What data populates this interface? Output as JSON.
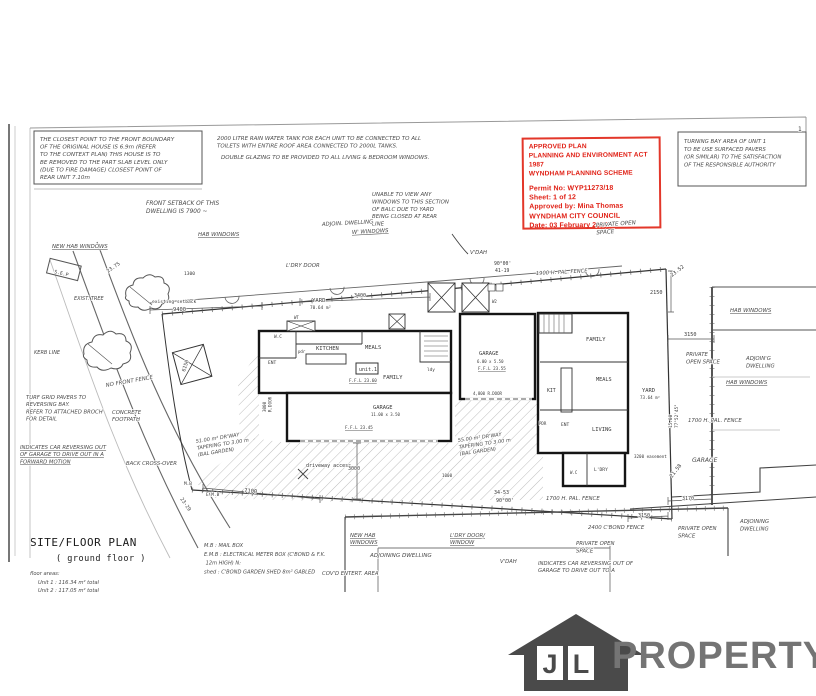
{
  "stamp": {
    "border_color": "#e3372a",
    "text_color": "#e01f14",
    "lines": [
      "APPROVED PLAN",
      "PLANNING AND ENVIRONMENT ACT 1987",
      "WYNDHAM PLANNING SCHEME",
      "Permit No:  WYP11273/18",
      "Sheet:  1 of 12",
      "Approved by:  Mina Thomas",
      "WYNDHAM CITY COUNCIL",
      "Date:  03 February 2020"
    ]
  },
  "logo": {
    "letters": [
      "J",
      "L"
    ],
    "name": "PROPERTY"
  },
  "plan": {
    "labels": [
      {
        "n": "note-boundary",
        "c": "hw",
        "x": 40,
        "y": 141,
        "s": 5.6,
        "lh": 7.6,
        "t": [
          "THE CLOSEST POINT TO THE FRONT BOUNDARY",
          "OF THE ORIGINAL HOUSE IS 6.9m (REFER",
          "TO THE CONTEXT PLAN) THIS HOUSE IS TO",
          "BE REMOVED TO THE PART SLAB LEVEL ONLY",
          "(DUE TO FIRE DAMAGE) CLOSEST POINT OF",
          "REAR UNIT  7.10m"
        ]
      },
      {
        "n": "note-rainwater",
        "c": "hw",
        "x": 217,
        "y": 140,
        "s": 5.5,
        "lh": 7.4,
        "t": [
          "2000 LITRE RAIN WATER TANK FOR EACH UNIT TO BE CONNECTED TO ALL",
          "TOILETS WITH ENTIRE ROOF AREA CONNECTED TO 2000L TANKS."
        ]
      },
      {
        "n": "note-glazing",
        "c": "hw",
        "x": 221,
        "y": 159,
        "s": 5.5,
        "t": "DOUBLE GLAZING TO BE PROVIDED TO ALL LIVING & BEDROOM WINDOWS."
      },
      {
        "n": "note-turning-bay",
        "c": "hw",
        "x": 684,
        "y": 143,
        "s": 5.4,
        "lh": 7.8,
        "t": [
          "TURNING BAY AREA OF UNIT 1",
          "TO BE USE SURFACED PAVERS",
          "(OR SIMILAR) TO THE SATISFACTION",
          "OF THE RESPONSIBLE AUTHORITY"
        ]
      },
      {
        "n": "note-front-setback",
        "c": "hw",
        "x": 146,
        "y": 205,
        "s": 5.8,
        "lh": 8.2,
        "t": [
          "FRONT SETBACK OF THIS",
          "DWELLING IS 7900 ~"
        ]
      },
      {
        "n": "note-balcony",
        "c": "hw",
        "x": 372,
        "y": 196,
        "s": 5.4,
        "lh": 7.4,
        "t": [
          "UNABLE TO VIEW ANY",
          "WINDOWS TO THIS SECTION",
          "OF BALC DUE TO YARD",
          "BEING CLOSED AT REAR",
          "LINE"
        ]
      },
      {
        "n": "stamp-handwriting",
        "c": "hw",
        "x": 596,
        "y": 227,
        "s": 5.6,
        "lh": 7.4,
        "r": -4,
        "t": [
          "PRIVATE OPEN",
          "SPACE"
        ]
      },
      {
        "c": "hw",
        "x": 322,
        "y": 226,
        "s": 5.4,
        "r": -3,
        "t": "ADJOIN. DWELLING"
      },
      {
        "c": "hw",
        "x": 352,
        "y": 234,
        "s": 5.4,
        "r": -3,
        "u": 1,
        "t": "W' WINDOWS"
      },
      {
        "c": "hw",
        "x": 198,
        "y": 236,
        "s": 5.4,
        "u": 1,
        "t": "HAB WINDOWS"
      },
      {
        "c": "hw",
        "x": 52,
        "y": 248,
        "s": 5.4,
        "u": 1,
        "t": "NEW HAB WINDOWS"
      },
      {
        "c": "hw",
        "x": 286,
        "y": 267,
        "s": 5.4,
        "t": "L'DRY DOOR"
      },
      {
        "c": "hw",
        "x": 470,
        "y": 254,
        "s": 5.4,
        "t": "V'DAH"
      },
      {
        "c": "hw",
        "x": 536,
        "y": 275,
        "s": 5.2,
        "r": -3,
        "t": "1900 H. PAL. FENCE"
      },
      {
        "c": "pr",
        "x": 494,
        "y": 265,
        "s": 4.8,
        "t": "90°00'"
      },
      {
        "c": "pr",
        "x": 495,
        "y": 272,
        "s": 4.8,
        "t": "41-19"
      },
      {
        "c": "pr",
        "x": 650,
        "y": 294,
        "s": 5.2,
        "t": "2150"
      },
      {
        "c": "pr",
        "x": 672,
        "y": 277,
        "s": 5.2,
        "r": -38,
        "t": "23.52"
      },
      {
        "c": "pr",
        "x": 684,
        "y": 336,
        "s": 5.2,
        "t": "3150"
      },
      {
        "c": "hw",
        "x": 730,
        "y": 312,
        "s": 5.4,
        "u": 1,
        "t": "HAB WINDOWS"
      },
      {
        "c": "hw",
        "x": 686,
        "y": 356,
        "s": 5.4,
        "lh": 7.4,
        "t": [
          "PRIVATE",
          "OPEN SPACE"
        ]
      },
      {
        "c": "hw",
        "x": 746,
        "y": 360,
        "s": 5.4,
        "lh": 7.4,
        "t": [
          "ADJOIN'G",
          "DWELLING"
        ]
      },
      {
        "c": "hw",
        "x": 726,
        "y": 384,
        "s": 5.4,
        "u": 1,
        "t": "HAB WINDOWS"
      },
      {
        "c": "pr",
        "x": 152,
        "y": 303,
        "s": 4.6,
        "t": "existing setback"
      },
      {
        "c": "pr",
        "x": 173,
        "y": 311,
        "s": 5.4,
        "t": "9400"
      },
      {
        "c": "pr",
        "x": 184,
        "y": 275,
        "s": 4.6,
        "t": "1300"
      },
      {
        "c": "pr",
        "x": 312,
        "y": 302,
        "s": 5.6,
        "t": "YARD"
      },
      {
        "c": "pr",
        "x": 310,
        "y": 309,
        "s": 4.4,
        "t": "70.64 m²"
      },
      {
        "c": "pr",
        "x": 354,
        "y": 297,
        "s": 5,
        "t": "3400"
      },
      {
        "c": "pr",
        "x": 108,
        "y": 273,
        "s": 5,
        "r": -35,
        "t": "23.75"
      },
      {
        "c": "pr",
        "x": 54,
        "y": 273,
        "s": 4.8,
        "r": 14,
        "t": "S.E.P"
      },
      {
        "c": "hw",
        "x": 74,
        "y": 300,
        "s": 5,
        "t": "EXIST. TREE"
      },
      {
        "c": "hw",
        "x": 34,
        "y": 354,
        "s": 5,
        "t": "KERB LINE"
      },
      {
        "c": "hw",
        "x": 106,
        "y": 387,
        "s": 5.4,
        "r": -10,
        "t": "NO FRONT FENCE"
      },
      {
        "n": "note-turf-pavers",
        "c": "hw",
        "x": 26,
        "y": 399,
        "s": 5.3,
        "lh": 7.2,
        "t": [
          "TURF GRID PAVERS TO",
          "REVERSING BAY.",
          "REFER TO ATTACHED BROCH",
          "FOR DETAIL"
        ]
      },
      {
        "c": "hw",
        "x": 112,
        "y": 414,
        "s": 5.3,
        "lh": 7.2,
        "t": [
          "CONCRETE",
          "FOOTPATH"
        ]
      },
      {
        "n": "note-reversing",
        "c": "hw",
        "x": 20,
        "y": 449,
        "s": 5.3,
        "lh": 7.2,
        "u": 1,
        "t": [
          "INDICATES CAR REVERSING OUT",
          "OF GARAGE TO DRIVE OUT IN A",
          "FORWARD MOTION"
        ]
      },
      {
        "c": "hw",
        "x": 126,
        "y": 465,
        "s": 5.3,
        "t": "BACK CROSS-OVER"
      },
      {
        "c": "pr",
        "x": 185,
        "y": 372,
        "s": 5,
        "r": -72,
        "t": "6150"
      },
      {
        "c": "hw",
        "x": 196,
        "y": 443,
        "s": 5,
        "lh": 6.8,
        "r": -9,
        "t": [
          "51.00 m² DR'WAY",
          "TAPERING TO 3.00 m",
          "(BAL GARDEN)"
        ]
      },
      {
        "c": "hw",
        "x": 458,
        "y": 442,
        "s": 5,
        "lh": 6.8,
        "r": -8,
        "t": [
          "55.00 m² DR'WAY",
          "TAPERING TO 3.00 m",
          "(BAL GARDEN)"
        ]
      },
      {
        "c": "pr",
        "x": 306,
        "y": 467,
        "s": 5,
        "t": "driveway access"
      },
      {
        "c": "pr",
        "x": 348,
        "y": 470,
        "s": 5,
        "t": "3000"
      },
      {
        "c": "pr",
        "x": 442,
        "y": 477,
        "s": 4.2,
        "t": "1000"
      },
      {
        "c": "pr",
        "x": 244,
        "y": 492,
        "s": 5.4,
        "r": 6,
        "t": "7100"
      },
      {
        "c": "pr",
        "x": 180,
        "y": 499,
        "s": 5,
        "r": 55,
        "t": "23-29"
      },
      {
        "c": "pr",
        "x": 184,
        "y": 485,
        "s": 4.4,
        "t": "M.B"
      },
      {
        "c": "pr",
        "x": 206,
        "y": 496,
        "s": 4.4,
        "t": "E.M.B"
      },
      {
        "c": "pr",
        "x": 274,
        "y": 338,
        "s": 4.4,
        "t": "W.C"
      },
      {
        "c": "pr",
        "x": 298,
        "y": 353,
        "s": 4,
        "t": "pdr"
      },
      {
        "c": "pr",
        "x": 268,
        "y": 364,
        "s": 4.6,
        "t": "ENT"
      },
      {
        "c": "pr",
        "x": 316,
        "y": 350,
        "s": 5.4,
        "t": "KITCHEN"
      },
      {
        "c": "pr",
        "x": 365,
        "y": 349,
        "s": 5.4,
        "t": "MEALS"
      },
      {
        "n": "unit1-label",
        "c": "pr",
        "x": 359,
        "y": 371,
        "s": 5,
        "t": "unit.1"
      },
      {
        "c": "pr",
        "x": 349,
        "y": 382,
        "s": 4.2,
        "u": 1,
        "t": "F.F.L  23.60"
      },
      {
        "c": "pr",
        "x": 383,
        "y": 379,
        "s": 5.4,
        "t": "FAMILY"
      },
      {
        "c": "pr",
        "x": 427,
        "y": 371,
        "s": 4.4,
        "t": "ldy"
      },
      {
        "c": "pr",
        "x": 294,
        "y": 319,
        "s": 4,
        "t": "WT"
      },
      {
        "c": "pr",
        "x": 373,
        "y": 409,
        "s": 5.4,
        "t": "GARAGE"
      },
      {
        "c": "pr",
        "x": 371,
        "y": 416,
        "s": 4,
        "t": "11.00 x 3.50"
      },
      {
        "c": "pr",
        "x": 345,
        "y": 429,
        "s": 4.2,
        "u": 1,
        "t": "F.F.L 23.45"
      },
      {
        "c": "pr",
        "x": 266,
        "y": 412,
        "s": 4.2,
        "r": -90,
        "lh": 5.6,
        "t": [
          "3000",
          "R.DOOR"
        ]
      },
      {
        "c": "pr",
        "x": 479,
        "y": 355,
        "s": 5.4,
        "t": "GARAGE"
      },
      {
        "c": "pr",
        "x": 477,
        "y": 363,
        "s": 4,
        "t": "6.00 x 5.50"
      },
      {
        "c": "pr",
        "x": 478,
        "y": 370,
        "s": 4.2,
        "u": 1,
        "t": "F.F.L 23.55"
      },
      {
        "c": "pr",
        "x": 473,
        "y": 395,
        "s": 4,
        "t": "4,800 R.DOOR"
      },
      {
        "c": "pr",
        "x": 492,
        "y": 303,
        "s": 4,
        "t": "W2"
      },
      {
        "c": "pr",
        "x": 586,
        "y": 341,
        "s": 5.4,
        "t": "FAMILY"
      },
      {
        "c": "pr",
        "x": 596,
        "y": 381,
        "s": 5.2,
        "t": "MEALS"
      },
      {
        "c": "pr",
        "x": 547,
        "y": 392,
        "s": 4.8,
        "t": "KIT"
      },
      {
        "c": "pr",
        "x": 539,
        "y": 425,
        "s": 4,
        "t": "PDR"
      },
      {
        "c": "pr",
        "x": 561,
        "y": 426,
        "s": 4.6,
        "t": "ENT"
      },
      {
        "c": "pr",
        "x": 592,
        "y": 431,
        "s": 5.4,
        "t": "LIVING"
      },
      {
        "c": "pr",
        "x": 594,
        "y": 471,
        "s": 4.6,
        "t": "L'DRY"
      },
      {
        "c": "pr",
        "x": 570,
        "y": 474,
        "s": 4,
        "t": "W.C"
      },
      {
        "c": "pr",
        "x": 642,
        "y": 392,
        "s": 5.4,
        "t": "YARD"
      },
      {
        "c": "pr",
        "x": 640,
        "y": 399,
        "s": 4.2,
        "t": "73.64 m²"
      },
      {
        "c": "pr",
        "x": 672,
        "y": 428,
        "s": 4.4,
        "r": -90,
        "lh": 5.8,
        "t": [
          "15.00",
          "77°52'45\""
        ]
      },
      {
        "c": "hw",
        "x": 688,
        "y": 422,
        "s": 5.4,
        "t": "1700 H. PAL. FENCE"
      },
      {
        "c": "pr",
        "x": 634,
        "y": 458,
        "s": 4.2,
        "t": "3200 easement"
      },
      {
        "c": "hw",
        "x": 692,
        "y": 462,
        "s": 6,
        "t": "GARAGE"
      },
      {
        "c": "pr",
        "x": 672,
        "y": 478,
        "s": 5.2,
        "r": -52,
        "t": "21.58"
      },
      {
        "c": "pr",
        "x": 682,
        "y": 500,
        "s": 5,
        "t": "3170"
      },
      {
        "c": "pr",
        "x": 638,
        "y": 517,
        "s": 5,
        "t": "3150"
      },
      {
        "c": "hw",
        "x": 678,
        "y": 530,
        "s": 5.4,
        "lh": 7.4,
        "t": [
          "PRIVATE OPEN",
          "SPACE"
        ]
      },
      {
        "c": "hw",
        "x": 740,
        "y": 523,
        "s": 5.4,
        "lh": 7.4,
        "t": [
          "ADJOINING",
          "DWELLING"
        ]
      },
      {
        "c": "pr",
        "x": 494,
        "y": 494,
        "s": 5,
        "t": "34-53"
      },
      {
        "c": "pr",
        "x": 496,
        "y": 502,
        "s": 5,
        "t": "90°00'"
      },
      {
        "c": "hw",
        "x": 546,
        "y": 500,
        "s": 5.4,
        "t": "1700 H. PAL. FENCE"
      },
      {
        "c": "hw",
        "x": 588,
        "y": 529,
        "s": 5.4,
        "t": "2400 C'BOND FENCE"
      },
      {
        "c": "hw",
        "x": 576,
        "y": 545,
        "s": 5.4,
        "lh": 7.4,
        "t": [
          "PRIVATE OPEN",
          "SPACE"
        ]
      },
      {
        "c": "hw",
        "x": 450,
        "y": 537,
        "s": 5.3,
        "lh": 7.2,
        "u": 1,
        "t": [
          "L'DRY DOOR/",
          "WINDOW"
        ]
      },
      {
        "c": "hw",
        "x": 350,
        "y": 537,
        "s": 5.3,
        "lh": 7.2,
        "u": 1,
        "t": [
          "NEW HAB",
          "WINDOWS"
        ]
      },
      {
        "c": "hw",
        "x": 370,
        "y": 557,
        "s": 5.6,
        "t": "ADJOINING DWELLING"
      },
      {
        "c": "hw",
        "x": 322,
        "y": 575,
        "s": 5.3,
        "t": "COV'D ENTERT. AREA"
      },
      {
        "c": "hw",
        "x": 500,
        "y": 563,
        "s": 5.3,
        "t": "V'DAH"
      },
      {
        "n": "note-reversing-2",
        "c": "hw",
        "x": 538,
        "y": 565,
        "s": 5.3,
        "lh": 7.2,
        "t": [
          "INDICATES CAR REVERSING OUT OF",
          "GARAGE TO DRIVE OUT TO A"
        ]
      },
      {
        "n": "plan-title",
        "c": "ttl",
        "x": 30,
        "y": 546,
        "s": 11,
        "t": "SITE/FLOOR PLAN"
      },
      {
        "n": "plan-subtitle",
        "c": "ttl",
        "x": 56,
        "y": 561,
        "s": 8.5,
        "t": "( ground floor )"
      },
      {
        "n": "floor-areas-heading",
        "c": "hw",
        "x": 30,
        "y": 575,
        "s": 5.2,
        "t": "floor areas:"
      },
      {
        "n": "floor-areas",
        "c": "hw",
        "x": 38,
        "y": 584,
        "s": 5.2,
        "lh": 8,
        "t": [
          "Unit 1 :  116.34 m²  total",
          "Unit 2 :  117.05 m²  total"
        ]
      },
      {
        "n": "legend",
        "c": "hw",
        "x": 204,
        "y": 547,
        "s": 5.1,
        "lh": 8.8,
        "t": [
          "M.B   :  MAIL BOX",
          "E.M.B :  ELECTRICAL METER BOX (C'BOND & F.K.",
          "            12m HIGH)  N:",
          "shed  :  C'BOND GARDEN SHED  8m²  GABLED"
        ]
      },
      {
        "n": "sheet-number",
        "c": "pr",
        "x": 798,
        "y": 131,
        "s": 6,
        "t": "1"
      }
    ]
  }
}
